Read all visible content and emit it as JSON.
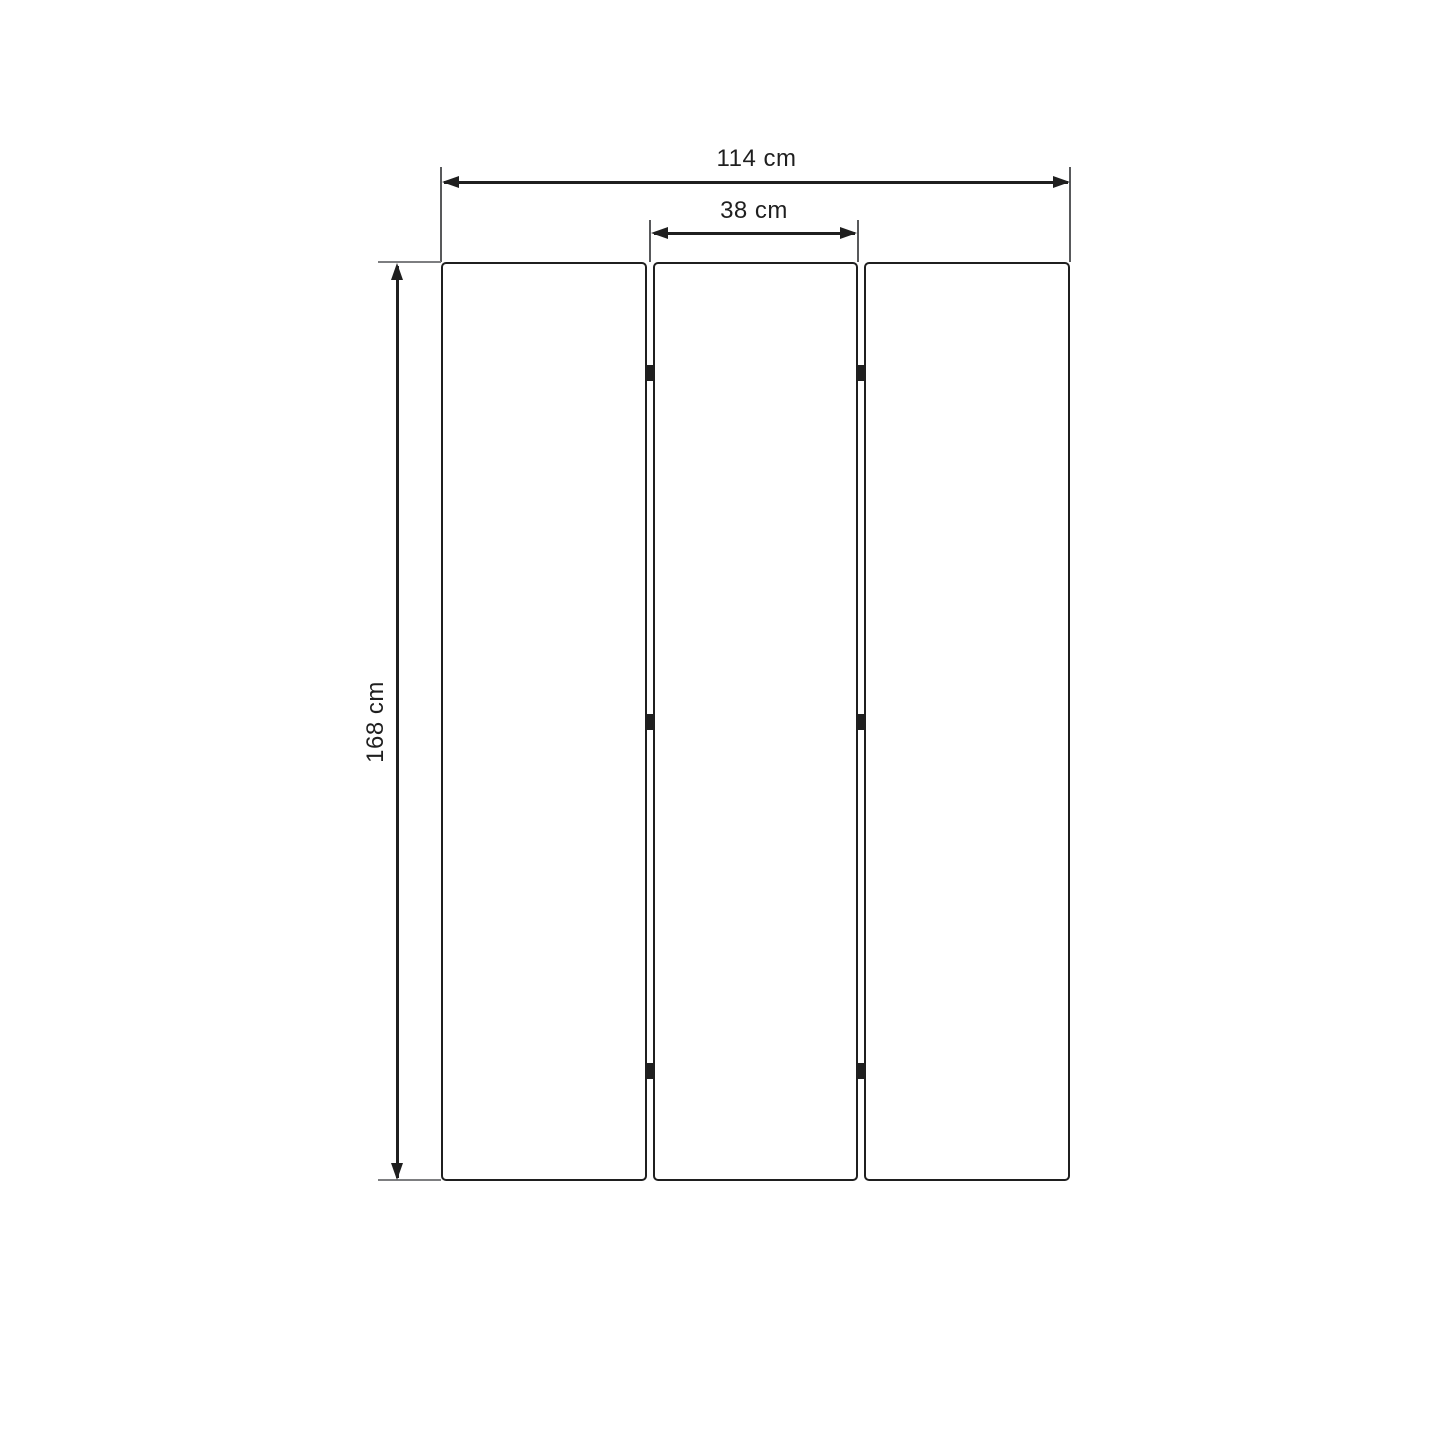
{
  "diagram": {
    "dimension_labels": {
      "total_width": "114 cm",
      "panel_width": "38 cm",
      "height": "168 cm"
    },
    "panel_count": 3,
    "hinge_count": 6,
    "colors": {
      "background": "#ffffff",
      "outline": "#1f1f1f",
      "extension_line": "#58595b",
      "baseline_line": "#7d7e80",
      "text": "#1f1f1f"
    }
  }
}
